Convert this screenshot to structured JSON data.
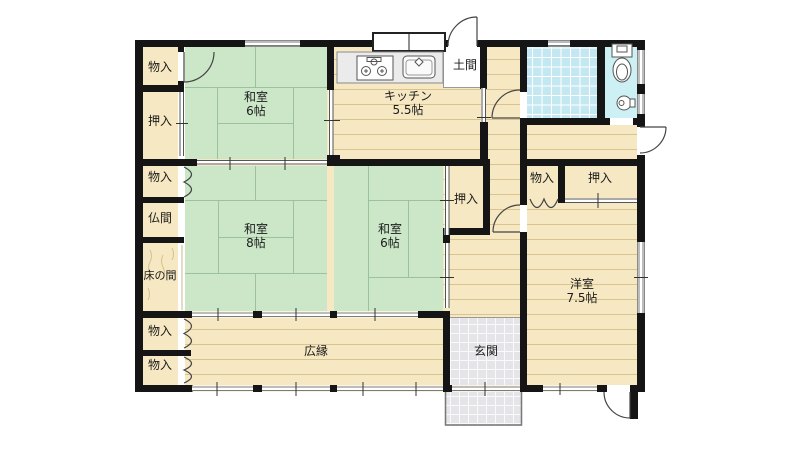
{
  "plan_title": "Japanese house floor plan",
  "colors": {
    "wall": "#151515",
    "tatami_green": "#cbe7c8",
    "tatami_line": "#9cc29c",
    "wood_cream": "#f6e8c2",
    "wood_line": "#d9c48f",
    "bath_blue": "#c4e8f2",
    "toilet_cyan": "#ccf0f3",
    "genkan_gray": "#e4e4e9",
    "window_gray": "#7a7a7a"
  },
  "rooms": {
    "storage_top_left": {
      "label": "物入"
    },
    "closet_left": {
      "label": "押入"
    },
    "washitsu_top": {
      "label": "和室",
      "size": "6帖"
    },
    "kitchen": {
      "label": "キッチン",
      "size": "5.5帖"
    },
    "doma": {
      "label": "土間"
    },
    "storage_mid_left": {
      "label": "物入"
    },
    "butsuma": {
      "label": "仏間"
    },
    "tokonoma": {
      "label": "床の間"
    },
    "washitsu_8": {
      "label": "和室",
      "size": "8帖"
    },
    "washitsu_6_center": {
      "label": "和室",
      "size": "6帖"
    },
    "closet_center": {
      "label": "押入"
    },
    "storage_west": {
      "label": "物入"
    },
    "closet_west": {
      "label": "押入"
    },
    "yoshitsu": {
      "label": "洋室",
      "size": "7.5帖"
    },
    "storage_bottom_1": {
      "label": "物入"
    },
    "storage_bottom_2": {
      "label": "物入"
    },
    "hiroen": {
      "label": "広縁"
    },
    "genkan": {
      "label": "玄関"
    }
  }
}
